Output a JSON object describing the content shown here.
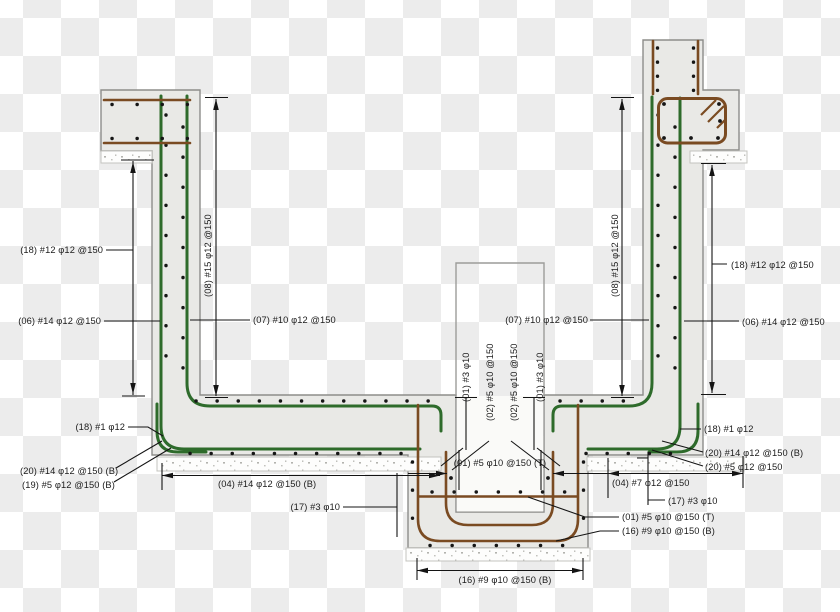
{
  "meta": {
    "drawing_type": "reinforced-concrete-section-detail"
  },
  "colors": {
    "concrete": "#e9e9e6",
    "concrete_outline": "#8d8d8a",
    "rebar_green": "#2e6b2b",
    "rebar_brown": "#7a4b22",
    "dimension_black": "#141414",
    "checker_grey": "#ececec",
    "checker_white": "#ffffff",
    "text": "#1b1b1b"
  },
  "callouts": {
    "left_wall_horiz_outer": "(18) #12 φ12 @150",
    "left_wall_vert_outer": "(06) #14 φ12 @150",
    "left_wall_vert_inner": "(07) #10 φ12 @150",
    "left_wall_horiz_inner": "(08) #15 φ12 @150",
    "right_wall_vert_inner": "(07) #10 φ12 @150",
    "right_wall_horiz_inner": "(08) #15 φ12 @150",
    "right_wall_horiz_outer": "(18) #12 φ12 @150",
    "right_wall_vert_outer": "(06) #14 φ12 @150",
    "center_tie_left": "(01) #3 φ10",
    "center_dowel_left": "(02) #5 φ10 @150",
    "center_dowel_right": "(02) #5 φ10 @150",
    "center_tie_right": "(01) #3 φ10",
    "slab_corner_left": "(18) #1 φ12",
    "slab_bottom_main_left": "(20) #14 φ12 @150 (B)",
    "slab_bottom_dist_left": "(19) #5 φ12 @150 (B)",
    "slab_bottom_span_left": "(04) #14 φ12 @150 (B)",
    "slab_ties_left": "(17) #3 φ10",
    "pit_top_mesh": "(01) #5 φ10 @150 (T)",
    "pit_bottom_mesh": "(16) #9 φ10 @150 (B)",
    "slab_corner_right": "(18) #1 φ12",
    "slab_bottom_main_right": "(20) #14 φ12 @150 (B)",
    "slab_bottom_dist_right": "(20) #5 φ12 @150",
    "slab_bottom_span_right": "(04) #7 φ12 @150",
    "slab_ties_right": "(17) #3 φ10",
    "pit_top_mesh_right": "(01) #5 φ10 @150 (T)",
    "pit_bottom_mesh_right": "(16) #9 φ10 @150 (B)"
  }
}
